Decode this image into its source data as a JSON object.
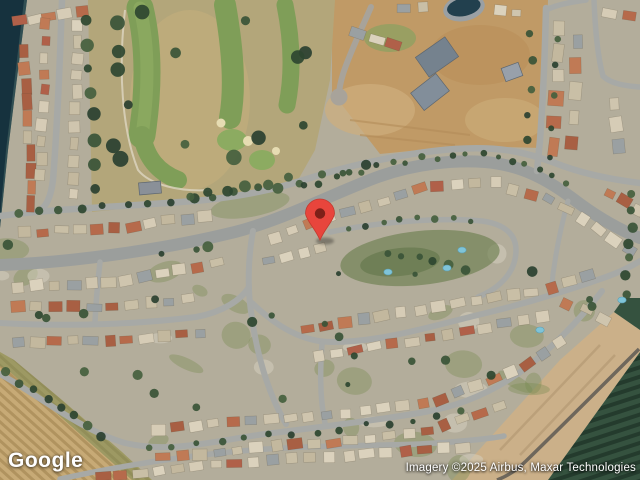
{
  "map": {
    "view_label": "satellite-imagery",
    "logo_text": "Google",
    "attribution_text": "Imagery ©2025 Airbus, Maxar Technologies",
    "marker": {
      "color": "#E8453C",
      "stroke_color": "#C23A2F",
      "inner_color": "#7E2018",
      "x": 320,
      "y": 240
    },
    "features": [
      "golf-course",
      "lake-shore",
      "residential-neighborhood",
      "dirt-construction-lots",
      "orchard-field",
      "curving-streets"
    ],
    "colors": {
      "water": "#16323E",
      "golf_fairway": "#7F9E58",
      "golf_rough": "#B3A67A",
      "dirt_lot": "#C09A66",
      "road": "#A7A9A6",
      "boulevard": "#9B9E9C",
      "orchard": "#2D4A3B",
      "field": "#C3A671",
      "roof_red": "#B66A4B",
      "roof_tan": "#D6CCB6",
      "tree": "#2E4630"
    }
  }
}
